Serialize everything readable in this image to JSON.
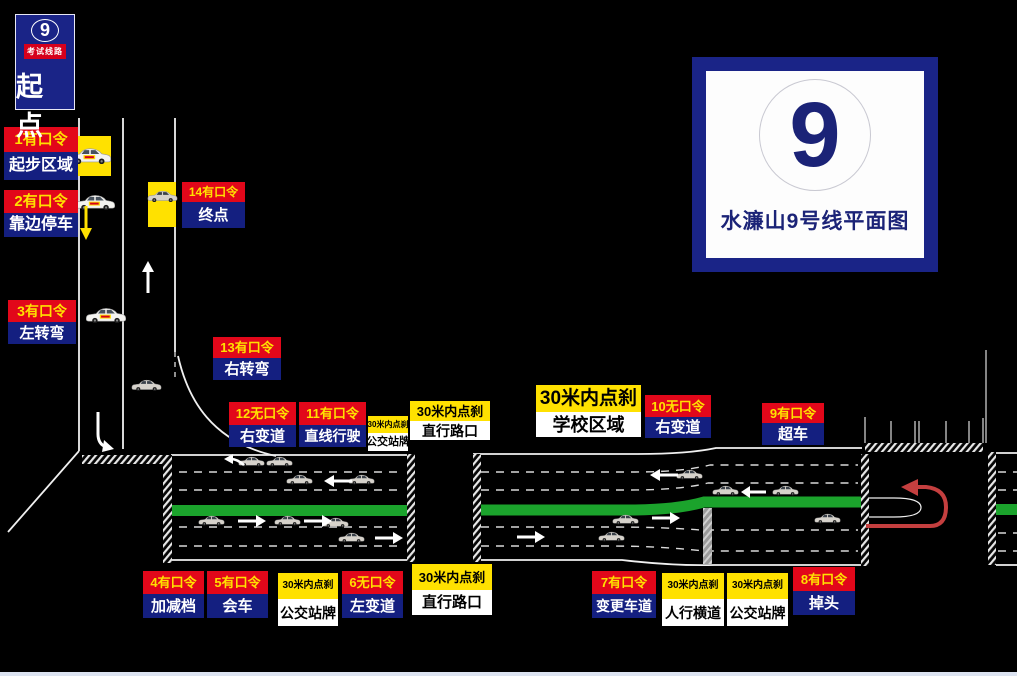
{
  "title_signs": {
    "start": {
      "line_number": "9",
      "route_type": "考试线路",
      "label": "起点"
    },
    "map": {
      "line_number": "9",
      "title": "水濂山9号线平面图"
    }
  },
  "colors": {
    "background": "#000000",
    "label_red": "#e2071a",
    "label_navy": "#141f80",
    "label_yellow": "#ffe100",
    "road_green": "#1ba32c",
    "uturn_arrow_red": "#c43f3f",
    "footer_strip": "#dce3f1"
  },
  "checkpoints": {
    "cp1": {
      "code": "1有口令",
      "action": "起步区域"
    },
    "cp2": {
      "code": "2有口令",
      "action": "靠边停车"
    },
    "cp3": {
      "code": "3有口令",
      "action": "左转弯"
    },
    "cp4": {
      "code": "4有口令",
      "action": "加减档"
    },
    "cp5": {
      "code": "5有口令",
      "action": "会车"
    },
    "cp6": {
      "code": "6无口令",
      "action": "左变道"
    },
    "cp7": {
      "code": "7有口令",
      "action": "变更车道"
    },
    "cp8": {
      "code": "8有口令",
      "action": "掉头"
    },
    "cp9": {
      "code": "9有口令",
      "action": "超车"
    },
    "cp10": {
      "code": "10无口令",
      "action": "右变道"
    },
    "cp11": {
      "code": "11有口令",
      "action": "直线行驶"
    },
    "cp12": {
      "code": "12无口令",
      "action": "右变道"
    },
    "cp13": {
      "code": "13有口令",
      "action": "右转弯"
    },
    "cp14": {
      "code": "14有口令",
      "action": "终点"
    }
  },
  "brake_points": {
    "bus_stop_mid": {
      "code": "30米内点刹",
      "action": "公交站牌"
    },
    "straight_cross_top": {
      "code": "30米内点刹",
      "action": "直行路口"
    },
    "school_zone": {
      "code": "30米内点刹",
      "action": "学校区域"
    },
    "bus_stop_bottom1": {
      "code": "30米内点刹",
      "action": "公交站牌"
    },
    "straight_cross_btm": {
      "code": "30米内点刹",
      "action": "直行路口"
    },
    "pedestrian_cross": {
      "code": "30米内点刹",
      "action": "人行横道"
    },
    "bus_stop_bottom2": {
      "code": "30米内点刹",
      "action": "公交站牌"
    }
  }
}
